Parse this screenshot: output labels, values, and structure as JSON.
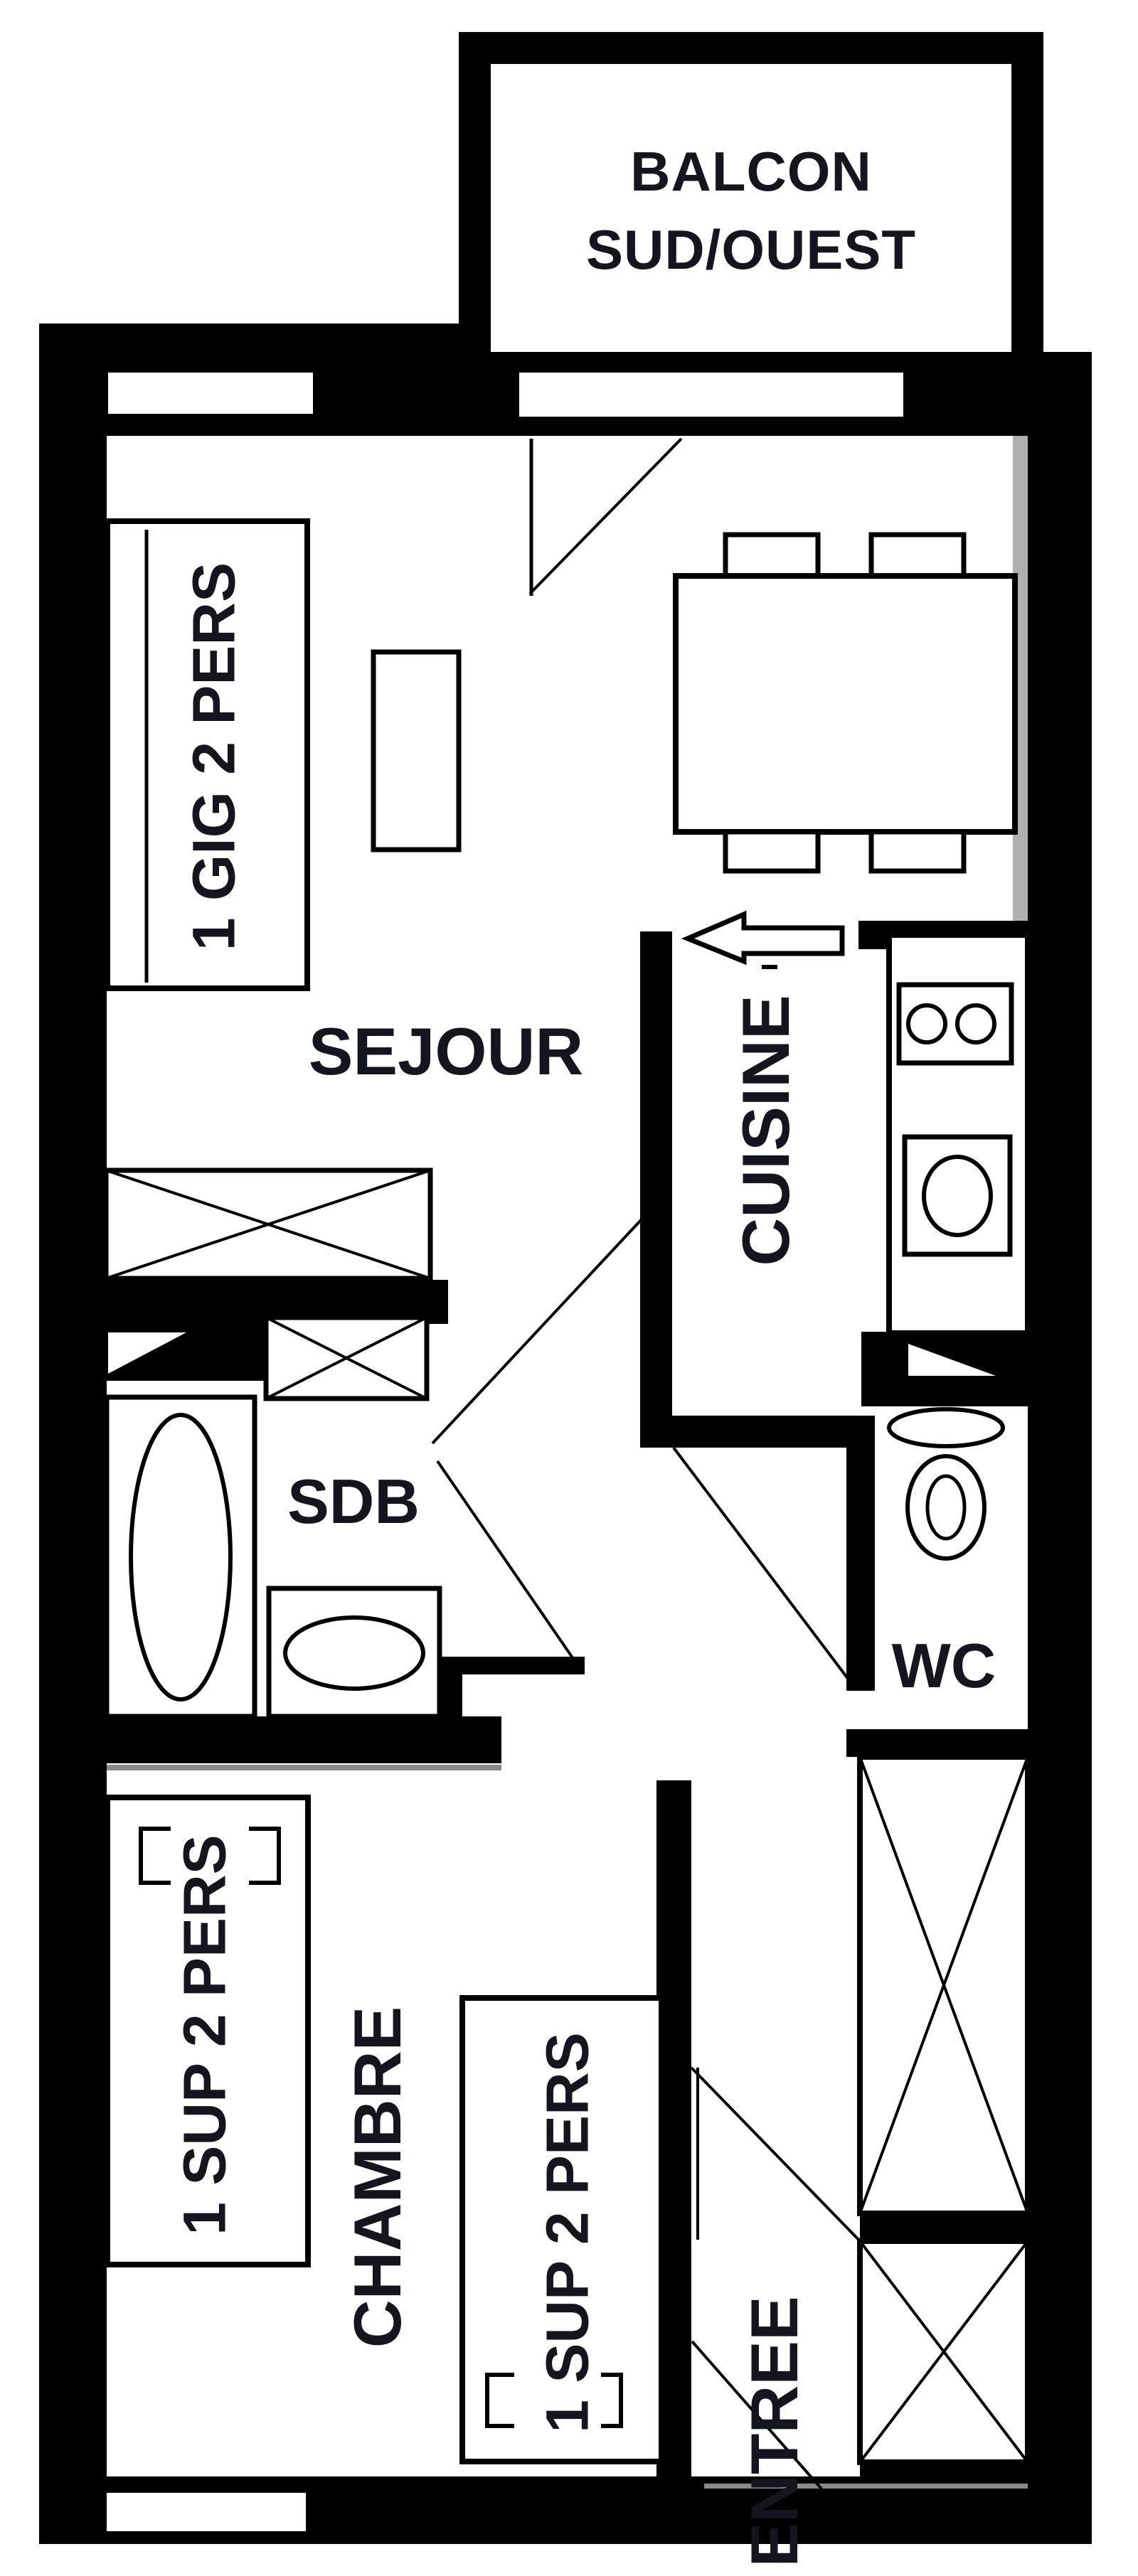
{
  "colors": {
    "wall": "#000000",
    "label": "#15151f",
    "background": "#ffffff",
    "shadow": "#8a8a8a"
  },
  "rooms": {
    "balcony": {
      "line1": "BALCON",
      "line2": "SUD/OUEST"
    },
    "living": {
      "label": "SEJOUR"
    },
    "kitchen": {
      "label": "CUISINE"
    },
    "bathroom": {
      "label": "SDB"
    },
    "wc": {
      "label": "WC"
    },
    "bedroom": {
      "label": "CHAMBRE"
    },
    "entry": {
      "label": "ENTREE"
    }
  },
  "furniture": {
    "sofa_bed": {
      "label": "1 GIG 2 PERS"
    },
    "bed_left": {
      "label": "1 SUP 2 PERS"
    },
    "bed_right": {
      "label": "1 SUP 2 PERS"
    }
  }
}
